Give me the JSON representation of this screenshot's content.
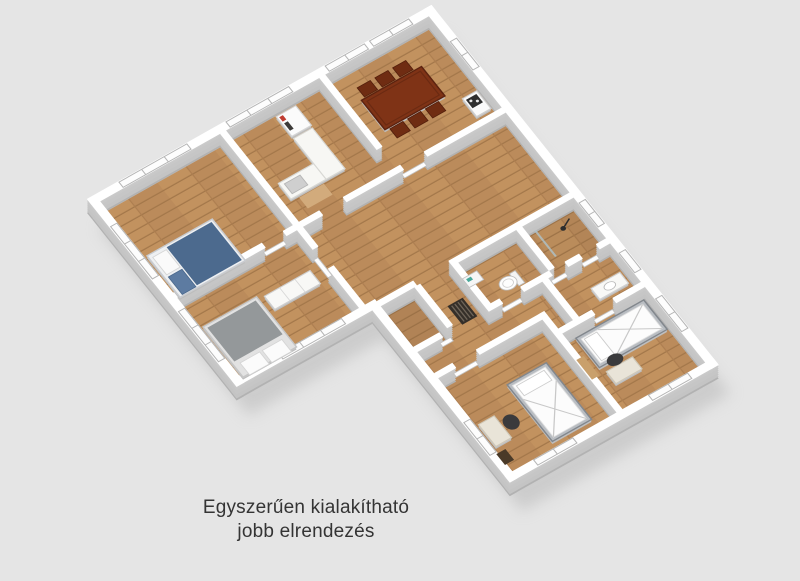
{
  "caption": {
    "line1": "Egyszerűen kialakítható",
    "line2": "jobb elrendezés"
  },
  "palette": {
    "background": "#e5e5e5",
    "wall_top": "#ffffff",
    "wall_side": "#c4c4c4",
    "floor_wood": "#bb8b5b",
    "floor_wood_line": "#a3774a",
    "dining_table": "#7f3316",
    "bed_blanket_blue": "#4c6a8e",
    "bed_blanket_gray": "#94989a",
    "fridge_accent_red": "#c03c30",
    "metal_frame": "#b9bdc2",
    "caption_text": "#343434"
  },
  "scene": {
    "view": "3d-isometric-floor-plan",
    "rooms": [
      {
        "name": "bedroom-double",
        "furniture": [
          "double-bed-blue",
          "windows"
        ]
      },
      {
        "name": "kitchen",
        "furniture": [
          "l-shaped-counter",
          "sink",
          "tall-fridge",
          "wood-board"
        ]
      },
      {
        "name": "dining-room",
        "furniture": [
          "dining-table",
          "six-chairs",
          "stove"
        ]
      },
      {
        "name": "bedroom-gray",
        "furniture": [
          "gray-bed",
          "white-dresser"
        ]
      },
      {
        "name": "hallway",
        "furniture": [
          "radiator",
          "doors"
        ]
      },
      {
        "name": "wc",
        "furniture": [
          "toilet",
          "sink"
        ]
      },
      {
        "name": "shower-room",
        "furniture": [
          "shower-head",
          "glass-panel"
        ]
      },
      {
        "name": "bathroom",
        "furniture": [
          "vanity-sink"
        ]
      },
      {
        "name": "bedroom-single-left",
        "furniture": [
          "single-bed",
          "desk",
          "chair"
        ]
      },
      {
        "name": "bedroom-single-right",
        "furniture": [
          "single-bed",
          "desk",
          "chair",
          "shelf"
        ]
      }
    ]
  }
}
